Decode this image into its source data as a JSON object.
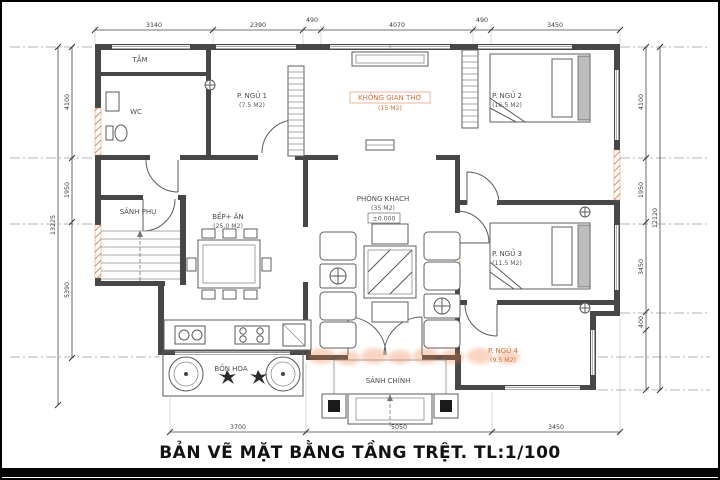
{
  "title": "BẢN VẼ MẶT BẰNG TẦNG TRỆT. TL:1/100",
  "colors": {
    "accent_orange": "#d4703a",
    "wall_gray": "#474747"
  },
  "rooms": {
    "tam": {
      "name": "TẮM"
    },
    "wc": {
      "name": "WC"
    },
    "ngu1": {
      "name": "P. NGỦ 1",
      "area": "(7.5 M2)"
    },
    "tho": {
      "name": "KHÔNG GIAN THỜ",
      "area": "(15 M2)"
    },
    "ngu2": {
      "name": "P. NGỦ 2",
      "area": "(16.5 M2)"
    },
    "sanh_phu": {
      "name": "SẢNH PHỤ"
    },
    "bep": {
      "name": "BẾP+ ĂN",
      "area": "(25.0 M2)"
    },
    "khach": {
      "name": "PHÒNG KHÁCH",
      "area": "(35 M2)",
      "level": "±0.000"
    },
    "ngu3": {
      "name": "P. NGỦ 3",
      "area": "(11.5 M2)"
    },
    "ngu4": {
      "name": "P. NGỦ 4",
      "area": "(9.5 M2)"
    },
    "bon_hoa": {
      "name": "BỒN HOA"
    },
    "sanh_chinh": {
      "name": "SẢNH CHÍNH"
    }
  },
  "dimensions": {
    "top": [
      "3140",
      "2390",
      "490",
      "4070",
      "490",
      "3450"
    ],
    "bottom": [
      "3700",
      "5050",
      "3450"
    ],
    "left": [
      "4100",
      "1950",
      "5390"
    ],
    "left_total": "13225",
    "right": [
      "4100",
      "1950",
      "3450",
      "400"
    ],
    "right_total": "12120"
  }
}
